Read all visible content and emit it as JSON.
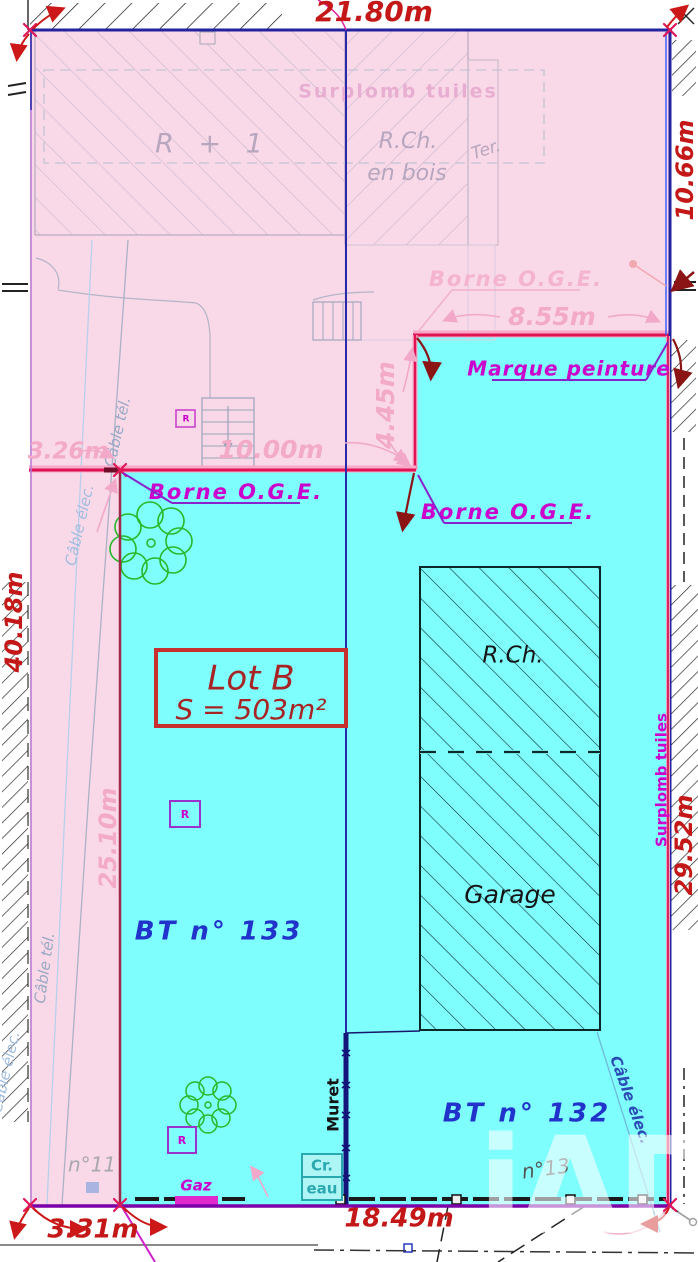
{
  "measurements": {
    "top": "21.80m",
    "right_upper": "10.66m",
    "step_width": "8.55m",
    "step_height": "4.45m",
    "left_offset": "3.26m",
    "mid_width": "10.00m",
    "left_outer": "40.18m",
    "strip": "25.10m",
    "right_lower": "29.52m",
    "bottom": "18.49m",
    "bottom_left": "3.31m"
  },
  "lot": {
    "name": "Lot B",
    "surface": "S = 503m²"
  },
  "parcels": {
    "left": "BT n° 133",
    "right": "BT n° 132"
  },
  "buildings": {
    "r1": "R + 1",
    "wood1": "R.Ch.",
    "wood2": "en bois",
    "ter": "Ter.",
    "rch": "R.Ch.",
    "garage": "Garage"
  },
  "notes": {
    "surplomb": "Surplomb tuiles",
    "borne": "Borne O.G.E.",
    "marque": "Marque peinture",
    "cable_elec": "Câble élec.",
    "cable_tel": "Câble tél.",
    "muret": "Muret",
    "gaz": "Gaz",
    "cr": "Cr.",
    "eau": "eau",
    "n11": "n°11",
    "n13": "n°13",
    "r": "R"
  },
  "watermark": "iAD",
  "colors": {
    "pink": "#f9d9e8",
    "cyan": "#7ffefe",
    "navy": "#2323a0",
    "crimson": "#e01454",
    "purple": "#7c00a8",
    "magenta": "#cc00cc",
    "red": "#c41818",
    "faint_pink": "#f2aac6",
    "blue_label": "#2233cc",
    "green": "#28b828",
    "teal": "#2aa8b0"
  }
}
